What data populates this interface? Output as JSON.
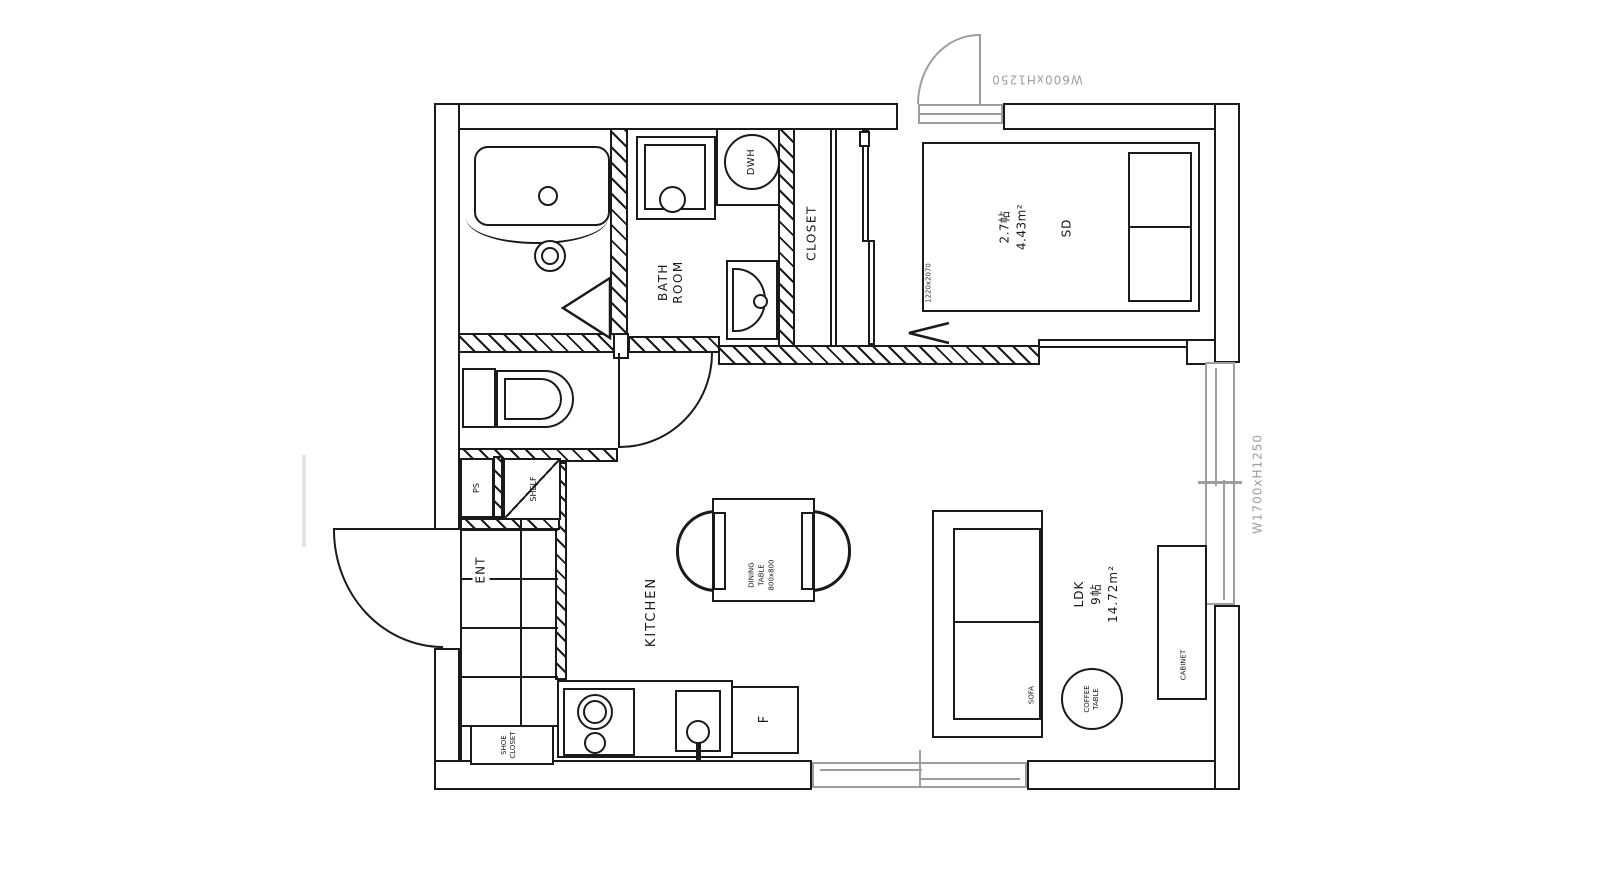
{
  "colors": {
    "line": "#1a1a1a",
    "gray": "#9e9e9e",
    "bg": "#ffffff"
  },
  "rooms": {
    "bathroom": {
      "label_lines": [
        "BATH",
        "ROOM"
      ]
    },
    "closet": {
      "label": "CLOSET"
    },
    "bedroom": {
      "area_tatami": "2.7帖",
      "area_m2": "4.43m²"
    },
    "ldk": {
      "label": "LDK",
      "area_tatami": "9帖",
      "area_m2": "14.72m²"
    },
    "kitchen": {
      "label": "KITCHEN"
    },
    "entrance": {
      "label": "ENT"
    }
  },
  "fixtures": {
    "dwh": {
      "label": "DWH"
    },
    "ps": {
      "label": "PS"
    },
    "shelf": {
      "label": "SHELF"
    },
    "shoe_closet": {
      "label_lines": [
        "SHOE",
        "CLOSET"
      ]
    },
    "fridge": {
      "label": "F"
    }
  },
  "furniture": {
    "bed": {
      "label": "SD",
      "size": "1220x2070"
    },
    "dining_table": {
      "label_lines": [
        "DINING",
        "TABLE",
        "800x800"
      ]
    },
    "sofa": {
      "label": "SOFA"
    },
    "coffee_table": {
      "label_lines": [
        "COFFEE",
        "TABLE"
      ]
    },
    "cabinet": {
      "label": "CABINET"
    }
  },
  "openings": {
    "top_door": {
      "size": "W600xH1250"
    },
    "right_window": {
      "size": "W1700xH1250"
    }
  }
}
